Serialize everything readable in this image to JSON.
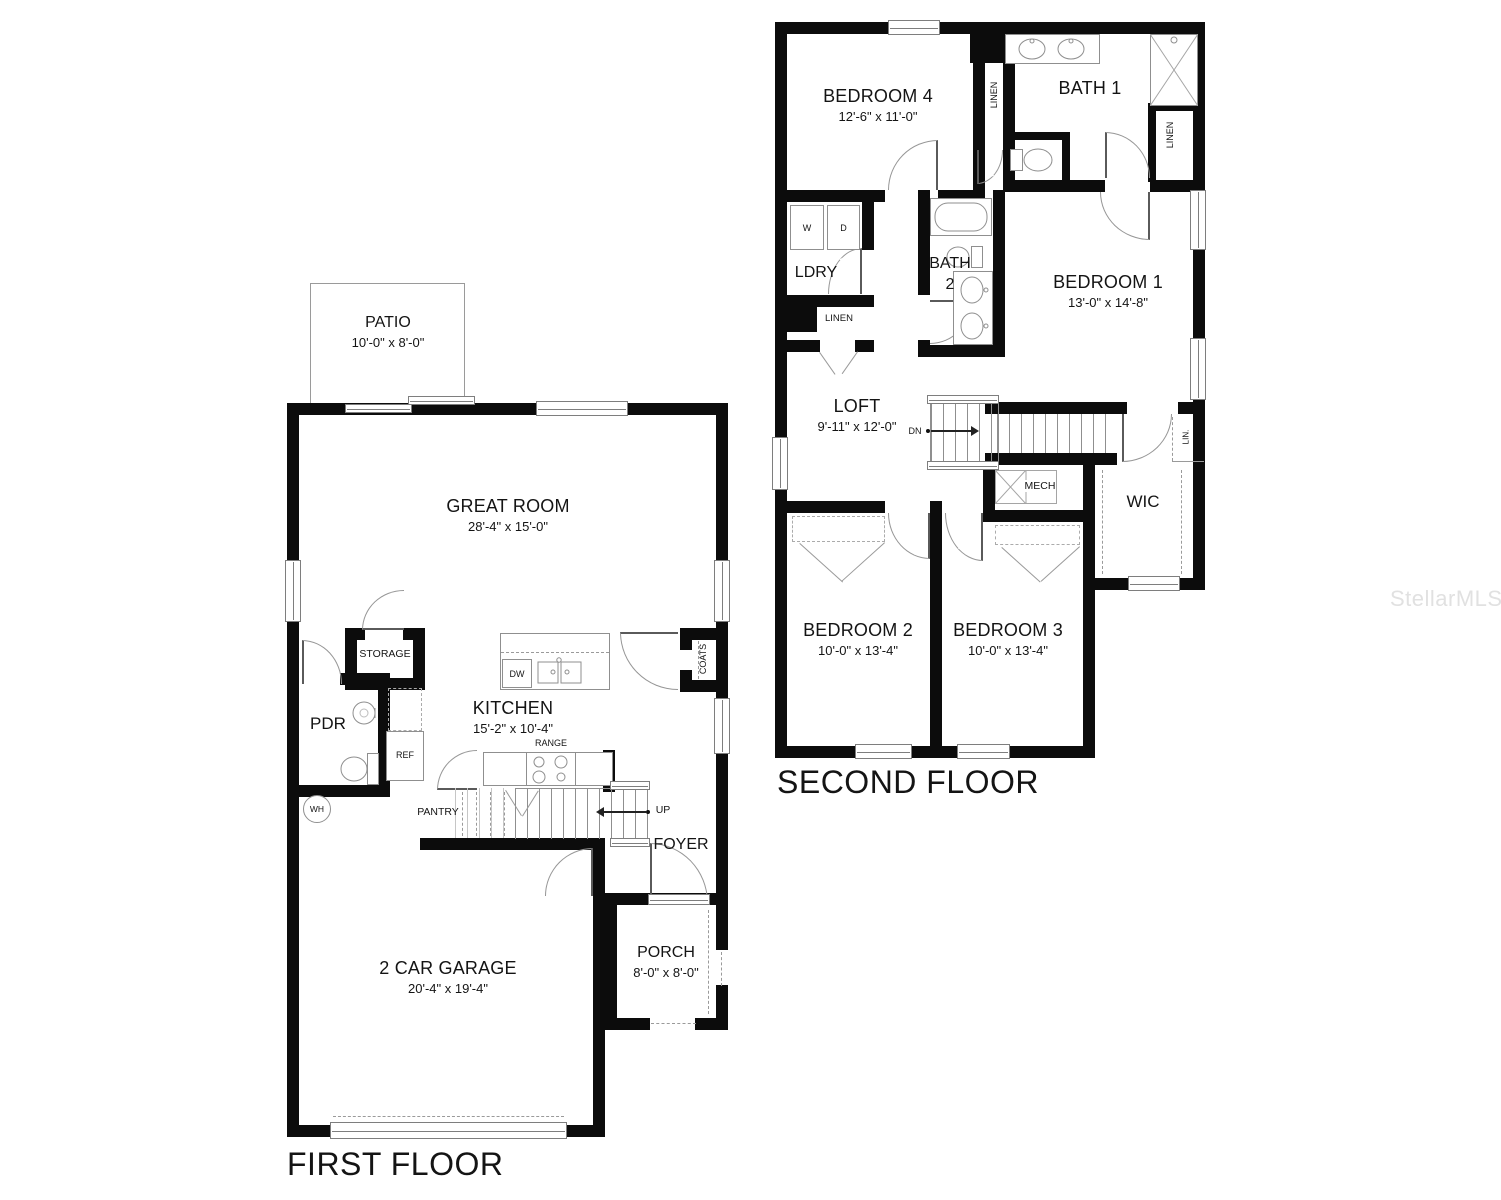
{
  "watermark": "StellarMLS",
  "first_floor": {
    "title": "FIRST FLOOR",
    "patio": {
      "name": "PATIO",
      "dims": "10'-0\" x 8'-0\""
    },
    "great_room": {
      "name": "GREAT ROOM",
      "dims": "28'-4\" x 15'-0\""
    },
    "kitchen": {
      "name": "KITCHEN",
      "dims": "15'-2\" x 10'-4\""
    },
    "garage": {
      "name": "2 CAR GARAGE",
      "dims": "20'-4\" x 19'-4\""
    },
    "porch": {
      "name": "PORCH",
      "dims": "8'-0\" x 8'-0\""
    },
    "pdr": "PDR",
    "storage": "STORAGE",
    "pantry": "PANTRY",
    "foyer": "FOYER",
    "coats": "COATS",
    "ref": "REF",
    "range": "RANGE",
    "dw": "DW",
    "wh": "WH",
    "up": "UP"
  },
  "second_floor": {
    "title": "SECOND FLOOR",
    "bedroom4": {
      "name": "BEDROOM 4",
      "dims": "12'-6\" x 11'-0\""
    },
    "bath1": "BATH 1",
    "bedroom1": {
      "name": "BEDROOM 1",
      "dims": "13'-0\" x 14'-8\""
    },
    "bedroom2": {
      "name": "BEDROOM 2",
      "dims": "10'-0\" x 13'-4\""
    },
    "bedroom3": {
      "name": "BEDROOM 3",
      "dims": "10'-0\" x 13'-4\""
    },
    "loft": {
      "name": "LOFT",
      "dims": "9'-11\" x 12'-0\""
    },
    "ldry": "LDRY",
    "bath2_line1": "BATH",
    "bath2_line2": "2",
    "wic": "WIC",
    "linen": "LINEN",
    "lin": "LIN.",
    "mech": "MECH",
    "dn": "DN",
    "washer": "W",
    "dryer": "D"
  }
}
